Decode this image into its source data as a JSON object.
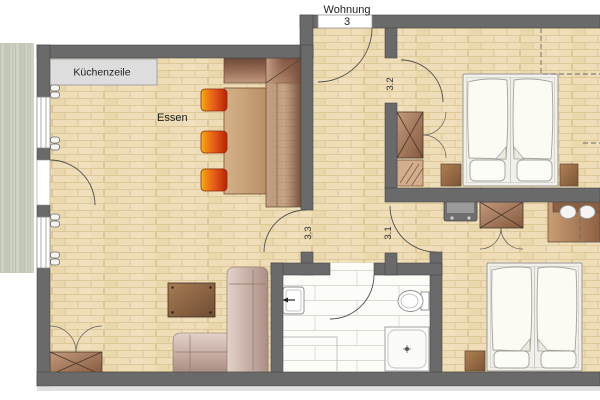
{
  "plan": {
    "apartment_label": {
      "line1": "Wohnung",
      "line2": "3"
    },
    "labels": {
      "kitchen": "Küchenzeile",
      "dining": "Essen"
    },
    "door_labels": {
      "d32": "3.2",
      "d33": "3.3",
      "d31": "3.1"
    },
    "colors": {
      "wall": "#6a6a6a",
      "floor_parquet": "#eeddb6",
      "parquet_line": "#d9c291",
      "floor_tile": "#fcfcf9",
      "tile_line": "#dadad4",
      "terrace": "#cdd2c3",
      "kitchen_unit": "#dddddd",
      "chair_orange": "#e8641c",
      "chair_red": "#c22f0b",
      "wood_brown": "#8a6248",
      "bench_dark": "#6e4a3a",
      "sofa_rose": "#cbb5ac",
      "bed_white": "#fbfaf3"
    }
  }
}
